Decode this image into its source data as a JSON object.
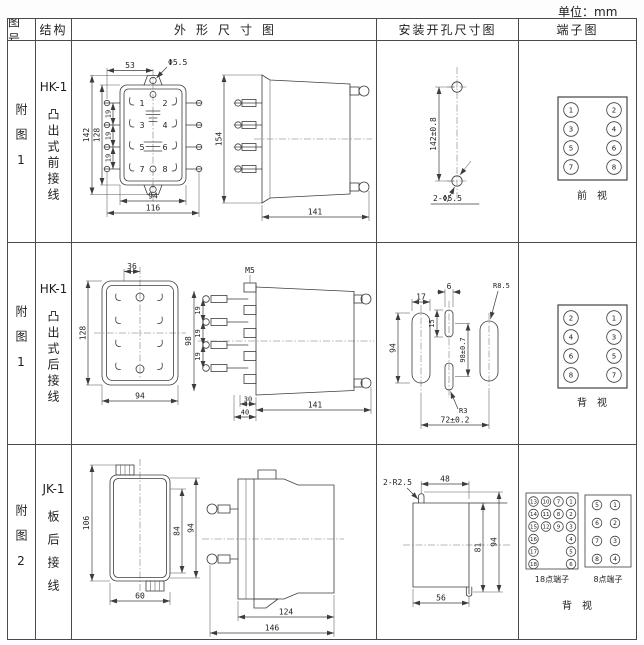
{
  "unit_label": "单位：mm",
  "header": {
    "figure": "图号",
    "structure": "结构",
    "outline": "外形尺寸图",
    "mounting": "安装开孔尺寸图",
    "terminal": "端子图"
  },
  "rows": [
    {
      "figure": "附图1",
      "model": "HK-1",
      "structure": "凸出式前接线",
      "outline": {
        "dim_top": "53",
        "hole_label": "Φ5.5",
        "height_outer": "142",
        "height_inner": "128",
        "pitch": [
          "19",
          "19",
          "19"
        ],
        "width_inner": "94",
        "width_outer": "116",
        "contacts": [
          "1",
          "2",
          "3",
          "4",
          "5",
          "6",
          "7",
          "8"
        ],
        "side_height": "154",
        "side_depth": "141"
      },
      "mounting": {
        "dim_vertical": "142±0.8",
        "holes_label": "2-Φ5.5"
      },
      "terminal": {
        "left": [
          "1",
          "3",
          "5",
          "7"
        ],
        "right": [
          "2",
          "4",
          "6",
          "8"
        ],
        "view": "前　视"
      }
    },
    {
      "figure": "附图1",
      "model": "HK-1",
      "structure": "凸出式后接线",
      "outline": {
        "dim_top": "36",
        "height": "128",
        "width": "94",
        "screw_label": "M5",
        "side_height": "98",
        "pitch": [
          "19",
          "19",
          "19"
        ],
        "dim_step": "30",
        "dim_base": "40",
        "side_depth": "141"
      },
      "mounting": {
        "slot_width": "17",
        "center_width": "6",
        "center_offset": "15",
        "slot_height": "94",
        "dim_vertical": "98±0.7",
        "radius_side": "R8.5",
        "radius_center": "R3",
        "dim_horizontal": "72±0.2"
      },
      "terminal": {
        "left": [
          "2",
          "4",
          "6",
          "8"
        ],
        "right": [
          "1",
          "3",
          "5",
          "7"
        ],
        "view": "背　视"
      }
    },
    {
      "figure": "附图2",
      "model": "JK-1",
      "structure": "板后接线",
      "outline": {
        "height_outer": "106",
        "height_inner": "84",
        "height_side": "94",
        "width": "60",
        "side_depth_inner": "124",
        "side_depth_outer": "146"
      },
      "mounting": {
        "radius_label": "2-R2.5",
        "dim_top": "48",
        "height_inner": "81",
        "height_outer": "94",
        "dim_bottom": "56"
      },
      "terminal18": {
        "label": "18点端子",
        "col1": [
          "13",
          "14",
          "15",
          "16",
          "17",
          "18"
        ],
        "col2": [
          "10",
          "11",
          "12"
        ],
        "col3": [
          "7",
          "8",
          "9"
        ],
        "col4": [
          "1",
          "2",
          "3",
          "4",
          "5",
          "6"
        ]
      },
      "terminal8": {
        "label": "8点端子",
        "left": [
          "5",
          "6",
          "7",
          "8"
        ],
        "right": [
          "1",
          "2",
          "3",
          "4"
        ]
      },
      "terminal_view": "背　视"
    }
  ]
}
